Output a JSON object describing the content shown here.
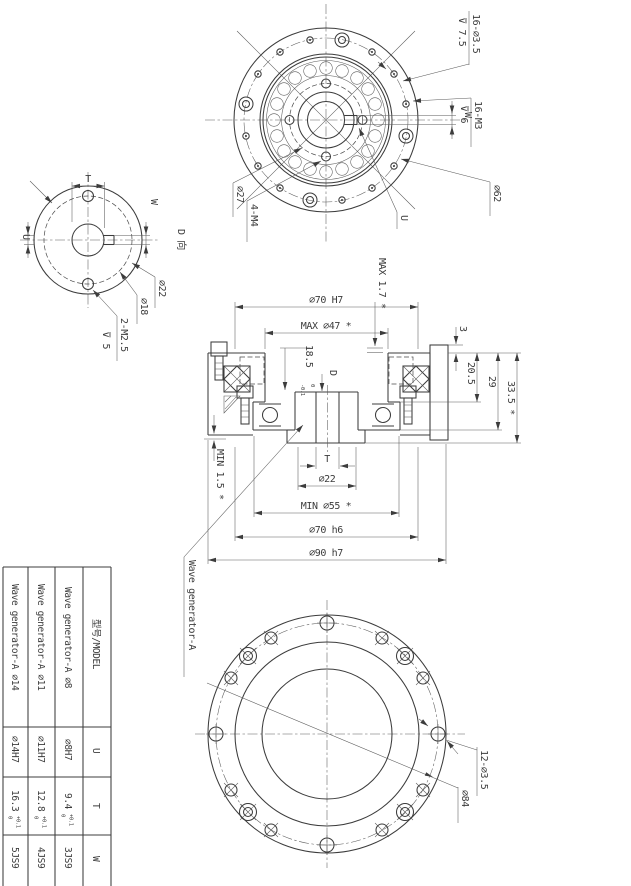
{
  "front_view": {
    "holes": "16-⌀3.5",
    "holes_depth": "⊽ 7.5",
    "tapped": "16-M3",
    "tapped_depth": "⊽ 6",
    "keyway_w": "W",
    "bearing_dia": "⌀62",
    "keyway_u": "U",
    "pitch_dia": "⌀27",
    "tapped4": "4-M4"
  },
  "d_view": {
    "title": "D 向",
    "t": "T",
    "w": "W",
    "u": "U",
    "hub_dia": "⌀22",
    "pitch_dia": "⌀18",
    "tapped": "2-M2.5",
    "tapped_depth": "⊽ 5"
  },
  "section": {
    "max17": "MAX 1.7 *",
    "bore": "⌀70 H7",
    "max47": "MAX ⌀47 *",
    "plate3": "3",
    "d205": "20.5",
    "d29": "29",
    "d335": "33.5 *",
    "d185": "18.5",
    "d185_tol_up": "0",
    "d185_tol_dn": "-0.1",
    "view_d": "D",
    "min15": "MIN 1.5 *",
    "t": "T",
    "d22": "⌀22",
    "min55": "MIN ⌀55 *",
    "spigot": "⌀70 h6",
    "flange": "⌀90 h7",
    "callout": "Wave generator-A"
  },
  "rear_view": {
    "holes": "12-⌀3.5",
    "bolt_circle": "⌀84"
  },
  "table": {
    "header_model": "型号/MODEL",
    "header_u": "U",
    "header_t": "T",
    "header_w": "W",
    "rows": [
      {
        "model": "Wave generator-A ⌀8",
        "u": "⌀8H7",
        "t": "9.4",
        "t_tol_up": "+0.1",
        "t_tol_dn": "0",
        "w": "3JS9"
      },
      {
        "model": "Wave generator-A ⌀11",
        "u": "⌀11H7",
        "t": "12.8",
        "t_tol_up": "+0.1",
        "t_tol_dn": "0",
        "w": "4JS9"
      },
      {
        "model": "Wave generator-A ⌀14",
        "u": "⌀14H7",
        "t": "16.3",
        "t_tol_up": "+0.1",
        "t_tol_dn": "0",
        "w": "5JS9"
      }
    ]
  }
}
